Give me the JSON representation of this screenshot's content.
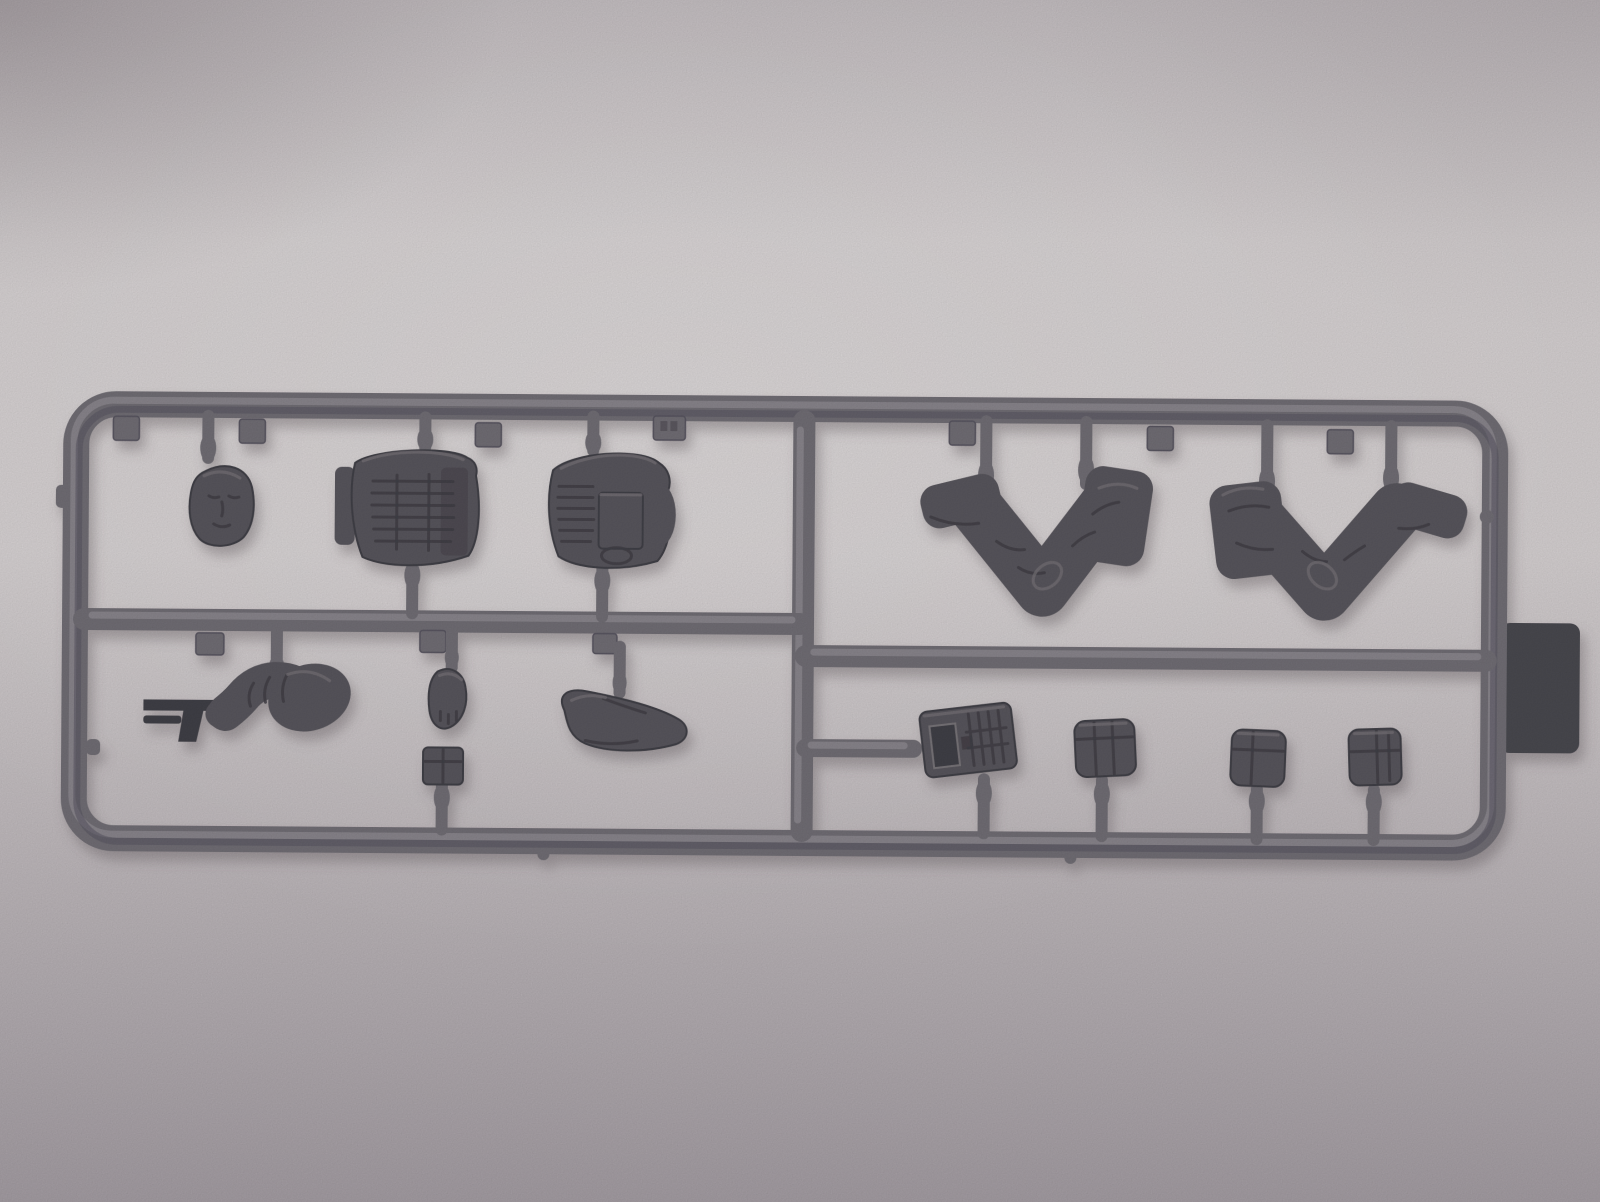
{
  "scene": {
    "description": "Photograph of a dark gray injection-molded plastic sprue (model figure parts frame) lying on light gray paper",
    "object": "model-kit-sprue",
    "background": "paper-sheet"
  },
  "colors": {
    "paper_light": "#d6d1d2",
    "paper_mid": "#c2bcbf",
    "paper_dark": "#a49da3",
    "runner": "#716e75",
    "runner_hl": "#918e94",
    "runner_dk": "#585560",
    "part": "#59565d",
    "part_dk": "#413f46",
    "part_hl": "#787479",
    "label_tab": "#4a4850",
    "cast_shadow": "#5d555b"
  },
  "parts": {
    "frame": "rectangular-sprue-frame",
    "items": [
      {
        "id": "head",
        "name": "figure-head"
      },
      {
        "id": "torso-vest-1",
        "name": "torso-with-ribbed-tactical-vest"
      },
      {
        "id": "torso-vest-2",
        "name": "torso-with-back-plate-vest"
      },
      {
        "id": "arm-with-pistol",
        "name": "bent-arm-holding-pistol"
      },
      {
        "id": "fist",
        "name": "clenched-hand"
      },
      {
        "id": "bent-arm",
        "name": "bent-arm"
      },
      {
        "id": "small-square-part",
        "name": "small-pouch-block"
      },
      {
        "id": "legs-seated-1",
        "name": "seated-legs-boot-left"
      },
      {
        "id": "legs-seated-2",
        "name": "seated-legs-boot-right"
      },
      {
        "id": "radio",
        "name": "handheld-radio"
      },
      {
        "id": "pouch-1",
        "name": "equipment-pouch"
      },
      {
        "id": "pouch-2",
        "name": "equipment-pouch"
      },
      {
        "id": "pouch-3",
        "name": "equipment-pouch"
      },
      {
        "id": "edge-tab",
        "name": "flat-molding-tab-on-right-rail"
      }
    ]
  }
}
